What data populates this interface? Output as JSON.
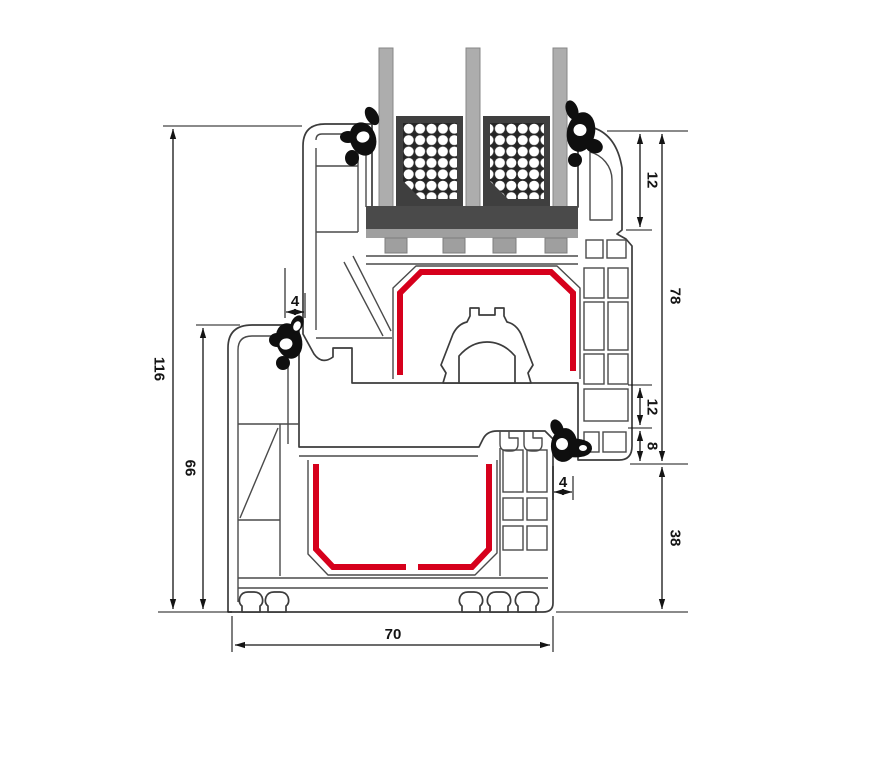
{
  "drawing": {
    "type": "window-profile-cross-section",
    "colors": {
      "outline": "#3c3c3c",
      "reinforcement_red": "#d6001c",
      "glass_gray": "#adadad",
      "spacer_dark": "#262626",
      "spacer_frame": "#3f3f3f",
      "glazing_bridge": "#4a4a4a",
      "glazing_bridge_light": "#9f9f9f",
      "gasket_black": "#0f0f0f",
      "dimension_lines": "#141414",
      "background": "#ffffff"
    },
    "dims": {
      "total_height": "116",
      "frame_height": "66",
      "gap_left": "4",
      "top_face": "12",
      "sash_height": "78",
      "mid_face": "12",
      "overlap": "8",
      "gap_right": "4",
      "frame_face": "38",
      "depth": "70"
    }
  }
}
